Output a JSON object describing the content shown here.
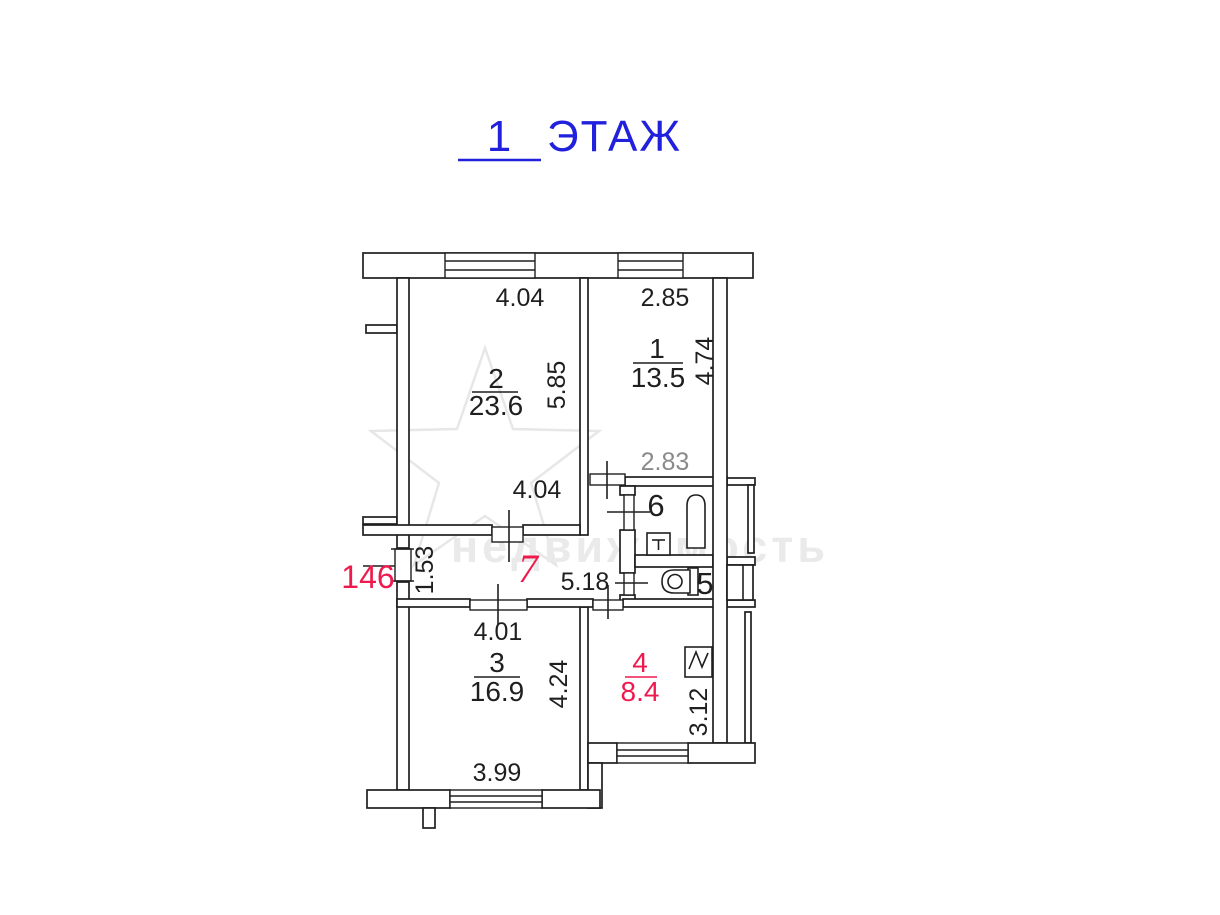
{
  "title": {
    "floor_number": "1",
    "floor_label": "ЭТАЖ"
  },
  "apartment": {
    "number": "146"
  },
  "watermark": {
    "text": "недвижимость"
  },
  "colors": {
    "title_blue": "#2020dd",
    "accent_red": "#ee1a4e",
    "dim_gray": "#8a8a8a",
    "line_black": "#1f1f1f",
    "watermark_gray": "#eaeaea"
  },
  "rooms": {
    "r1": {
      "number": "1",
      "area": "13.5",
      "dim_top": "2.85",
      "dim_right": "4.74",
      "dim_bottom": "2.83"
    },
    "r2": {
      "number": "2",
      "area": "23.6",
      "dim_top": "4.04",
      "dim_right": "5.85",
      "dim_bottom": "4.04"
    },
    "r3": {
      "number": "3",
      "area": "16.9",
      "dim_top": "4.01",
      "dim_right": "4.24",
      "dim_bottom": "3.99"
    },
    "r4": {
      "number": "4",
      "area": "8.4",
      "dim_right": "3.12"
    },
    "r5": {
      "number": "5"
    },
    "r6": {
      "number": "6"
    },
    "r7": {
      "number": "7",
      "dim_left": "1.53",
      "dim_bottom": "5.18"
    }
  }
}
